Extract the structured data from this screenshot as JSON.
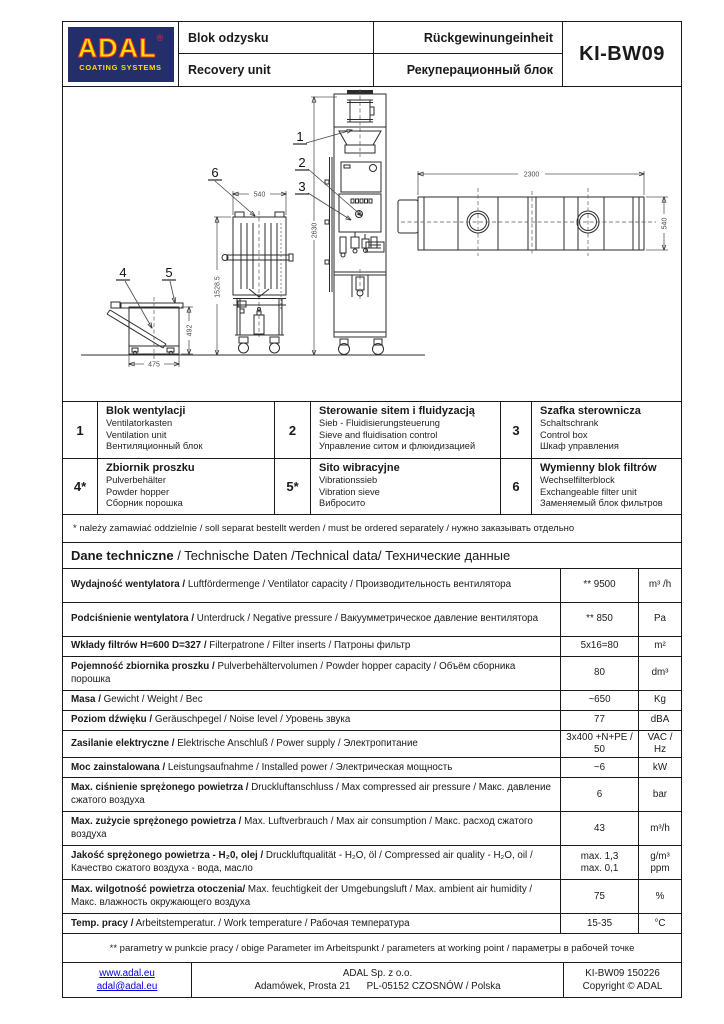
{
  "header": {
    "logo": {
      "brand": "ADAL",
      "registered_mark": "®",
      "tagline": "COATING SYSTEMS",
      "colors": {
        "background": "#242e6b",
        "letters": "#ffdf00",
        "outline": "#e03131"
      }
    },
    "product_name": {
      "pl": "Blok odzysku",
      "en": "Recovery unit",
      "de": "Rückgewinungeinheit",
      "ru": "Рекуперационный блок"
    },
    "model": "KI-BW09"
  },
  "drawing": {
    "callouts": [
      "1",
      "2",
      "3",
      "4",
      "5",
      "6"
    ],
    "dimensions": {
      "unit_height": "2630",
      "filter_unit_height": "1528.5",
      "filter_unit_width": "540",
      "hopper_width": "475",
      "hopper_height": "492",
      "top_view_length": "2300",
      "top_view_depth": "540"
    }
  },
  "parts": [
    {
      "num": "1",
      "pl": "Blok wentylacji",
      "de": "Ventilatorkasten",
      "en": "Ventilation unit",
      "ru": "Вентиляционный блок"
    },
    {
      "num": "2",
      "pl": "Sterowanie sitem i fluidyzacją",
      "de": "Sieb - Fluidisierungsteuerung",
      "en": "Sieve and fluidisation control",
      "ru": "Управление ситом и флюидизацией"
    },
    {
      "num": "3",
      "pl": "Szafka sterownicza",
      "de": "Schaltschrank",
      "en": "Control box",
      "ru": "Шкаф управления"
    },
    {
      "num": "4*",
      "pl": "Zbiornik proszku",
      "de": "Pulverbehälter",
      "en": "Powder hopper",
      "ru": "Сборник порошка"
    },
    {
      "num": "5*",
      "pl": "Sito wibracyjne",
      "de": "Vibrationssieb",
      "en": "Vibration sieve",
      "ru": "Вибросито"
    },
    {
      "num": "6",
      "pl": "Wymienny blok filtrów",
      "de": "Wechselfilterblock",
      "en": "Exchangeable filter unit",
      "ru": "Заменяемый блок фильтров"
    }
  ],
  "notes": {
    "order": "* należy zamawiać oddzielnie / soll separat bestellt werden / must be ordered separately / нужно заказывать отдельно",
    "working_point": "** parametry w punkcie pracy / obige Parameter im Arbeitspunkt / parameters at working point / параметры в рабочей точке"
  },
  "tech": {
    "heading": {
      "bold": "Dane techniczne",
      "rest": " / Technische Daten /Technical data/ Технические данные"
    },
    "rows": [
      {
        "bold": "Wydajność wentylatora /",
        "rest": " Luftfördermenge / Ventilator capacity / Производительность вентилятора",
        "value": "** 9500",
        "unit": "m³ /h"
      },
      {
        "bold": "Podciśnienie wentylatora /",
        "rest": " Unterdruck / Negative pressure / Вакуумметрическое давление вентилятора",
        "value": "** 850",
        "unit": "Pa"
      },
      {
        "bold": "Wkłady filtrów  H=600 D=327 /",
        "rest": " Filterpatrone / Filter inserts / Патроны фильтр",
        "value": "5x16=80",
        "unit": "m²"
      },
      {
        "bold": "Pojemność zbiornika proszku /",
        "rest": " Pulverbehältervolumen / Powder hopper capacity / Объём сборника порошка",
        "value": "80",
        "unit": "dm³"
      },
      {
        "bold": "Masa /",
        "rest": " Gewicht / Weight / Вес",
        "value": "~650",
        "unit": "Kg"
      },
      {
        "bold": "Poziom dźwięku /",
        "rest": " Geräuschpegel / Noise level / Уровень звука",
        "value": "77",
        "unit": "dBA"
      },
      {
        "bold": "Zasilanie elektryczne /",
        "rest": " Elektrische Anschluß / Power supply  / Электропитание",
        "value": "3x400 +N+PE / 50",
        "unit": "VAC / Hz"
      },
      {
        "bold": "Moc zainstalowana /",
        "rest": " Leistungsaufnahme / Installed power / Электрическая мощность",
        "value": "~6",
        "unit": "kW"
      },
      {
        "bold": "Max. ciśnienie sprężonego powietrza /",
        "rest": " Druckluftanschluss / Max compressed air pressure / Макс. давление сжатого воздуха",
        "value": "6",
        "unit": "bar"
      },
      {
        "bold": "Max. zużycie sprężonego powietrza /",
        "rest": " Max. Luftverbrauch / Max air consumption / Макс. расход сжатого воздуха",
        "value": "43",
        "unit": "m³/h"
      },
      {
        "bold": "Jakość sprężonego powietrza - H₂0, olej /",
        "rest": " Druckluftqualität - H₂O, öl / Compressed air quality - H₂O, oil / Качество сжатого воздуха - вода, масло",
        "value": "max.  1,3\nmax.  0,1",
        "unit": "g/m³\nppm"
      },
      {
        "bold": "Max. wilgotność powietrza otoczenia/",
        "rest": " Max. feuchtigkeit  der Umgebungsluft / Max. ambient  air humidity /  Макс. влажность окружающего воздуха",
        "value": "75",
        "unit": "%"
      },
      {
        "bold": "Temp. pracy /",
        "rest": " Arbeitstemperatur.  / Work temperature /  Рабочая температура",
        "value": "15-35",
        "unit": "°C"
      }
    ]
  },
  "footer": {
    "website": "www.adal.eu",
    "email": "adal@adal.eu",
    "company": "ADAL Sp. z o.o.",
    "address1": "Adamówek, Prosta 21",
    "address2": "PL-05152 CZOSNÓW / Polska",
    "doc_code": "KI-BW09 150226",
    "copyright": "Copyright © ADAL"
  }
}
